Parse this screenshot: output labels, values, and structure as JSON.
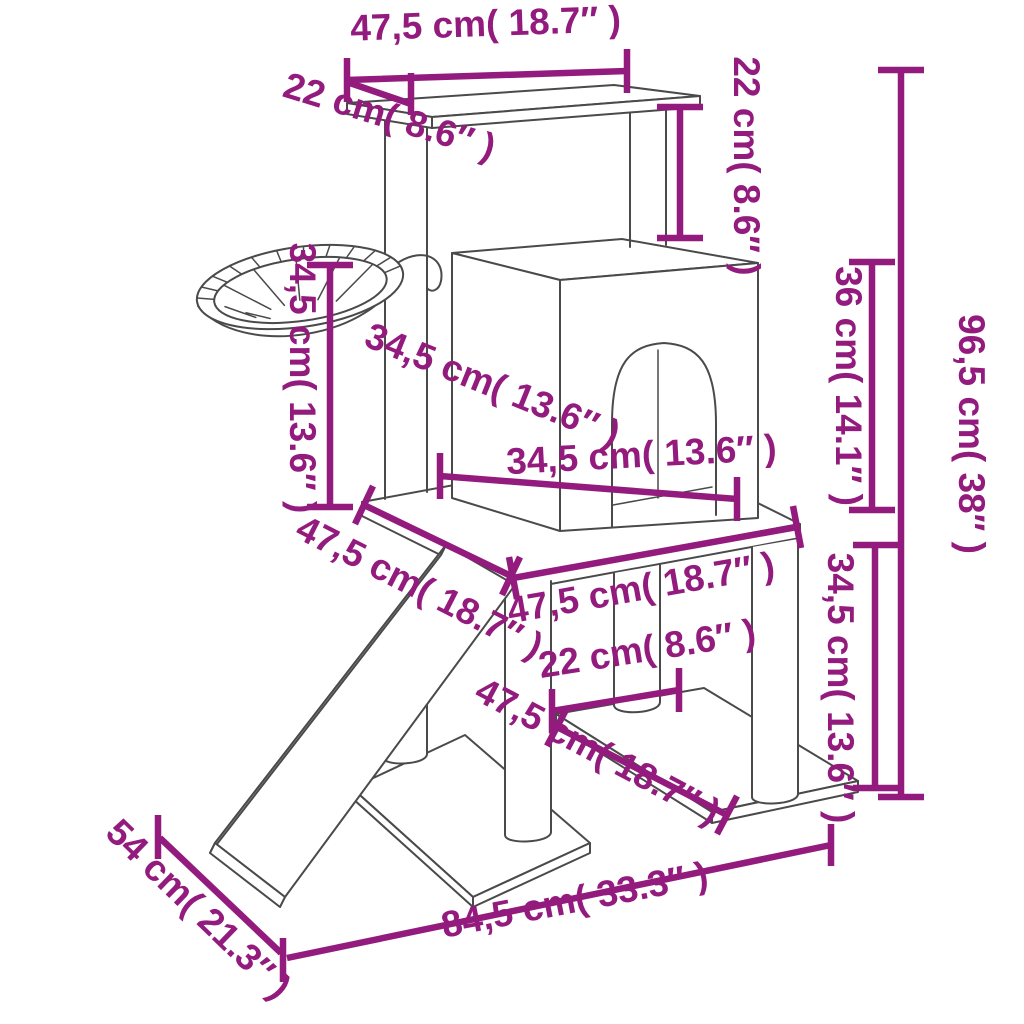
{
  "diagram": {
    "title": "cat-tree-dimension-diagram",
    "accent_color": "#941b7e",
    "line_color": "#4a4a4a",
    "dimensions": {
      "top_platform_width": "47,5 cm( 18.7″ )",
      "top_platform_depth": "22 cm( 8.6″ )",
      "top_to_house_height": "22 cm( 8.6″ )",
      "total_height": "96,5 cm( 38″ )",
      "house_height": "36 cm( 14.1″ )",
      "basket_height": "34,5 cm( 13.6″ )",
      "house_depth": "34,5 cm( 13.6″ )",
      "house_width": "34,5 cm( 13.6″ )",
      "middle_platform_depth": "47,5 cm( 18.7″ )",
      "middle_platform_width": "47,5 cm( 18.7″ )",
      "post_gap": "22 cm( 8.6″ )",
      "lower_platform_width": "47,5 cm( 18.7″ )",
      "lower_section_height": "34,5 cm( 13.6″ )",
      "base_depth": "54 cm( 21.3″ )",
      "base_width": "84,5 cm( 33.3″ )"
    }
  }
}
